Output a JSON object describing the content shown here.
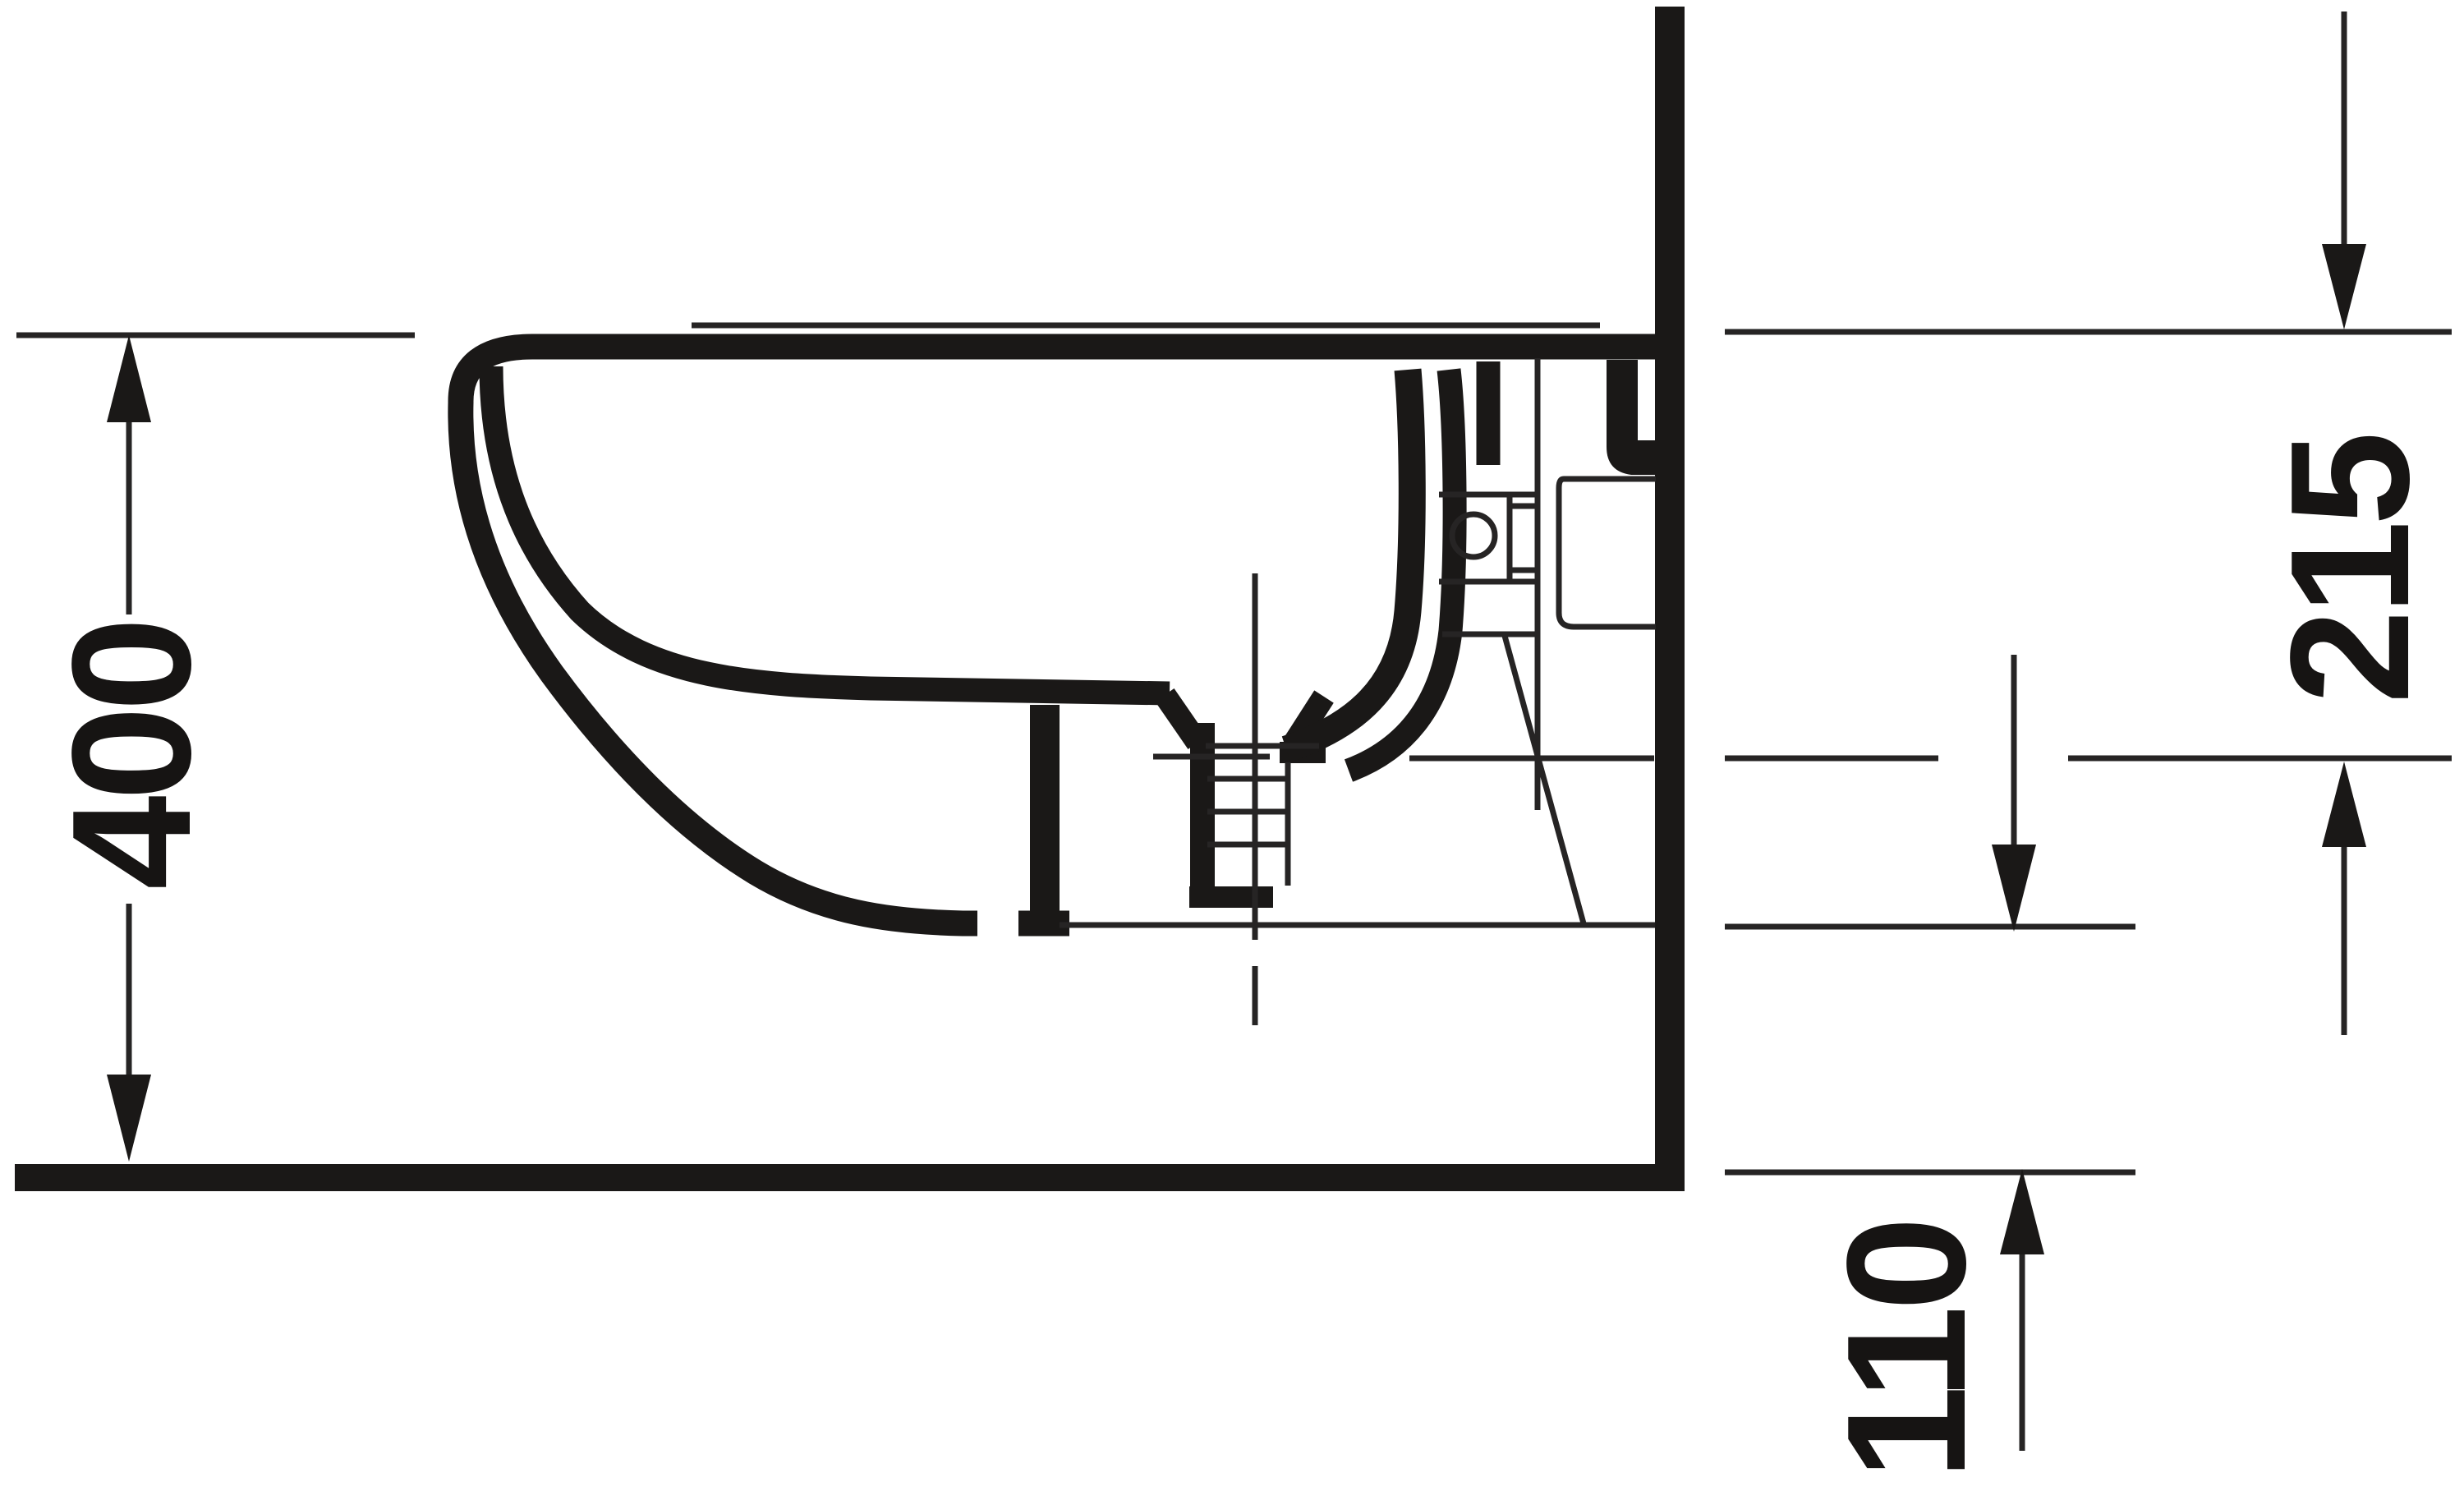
{
  "drawing": {
    "background_color": "#ffffff",
    "ink_color": "#1a1817",
    "thin_line_color": "#262424",
    "dimensions": {
      "left": {
        "value": "400",
        "orientation": "vertical-rotated"
      },
      "right": {
        "value": "215",
        "orientation": "vertical-rotated"
      },
      "bottom_right": {
        "value": "110",
        "orientation": "vertical-rotated"
      }
    }
  }
}
